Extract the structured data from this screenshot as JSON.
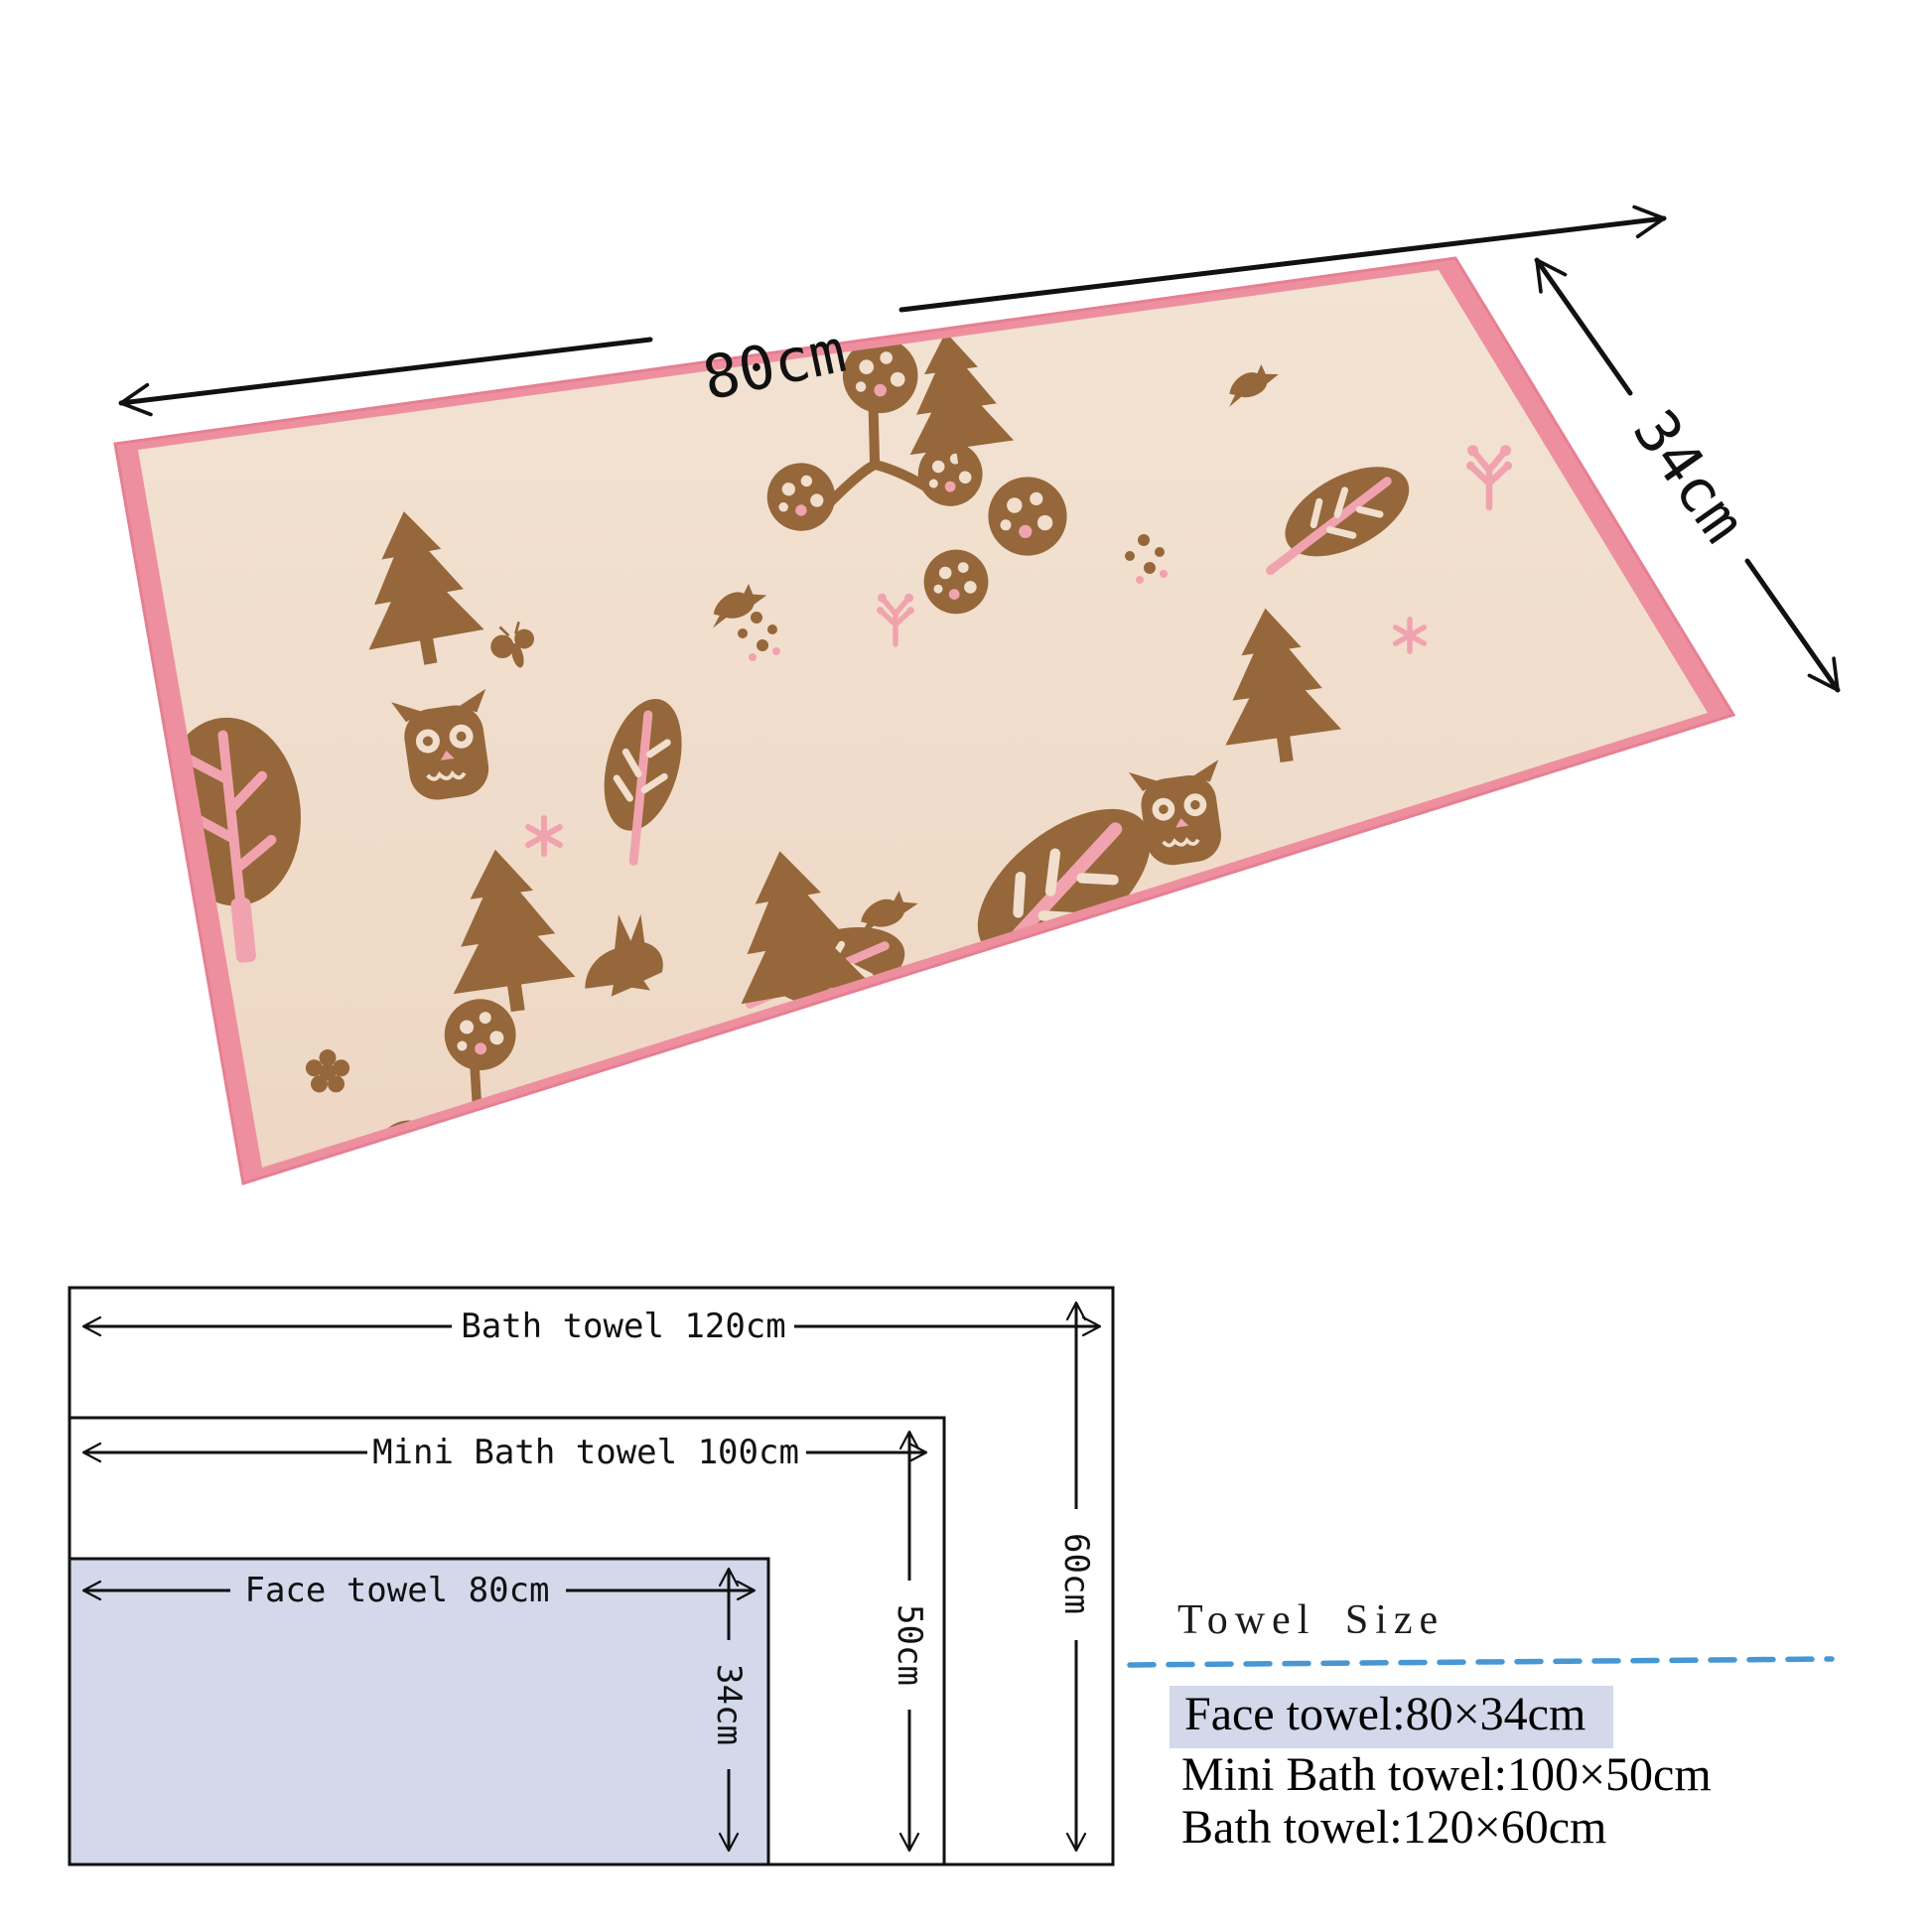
{
  "photo": {
    "width_label": "80cm",
    "height_label": "34cm",
    "motifs": [
      "round-tree",
      "pine-tree",
      "leaf",
      "owl",
      "bird",
      "rabbit",
      "berry-cluster",
      "flower",
      "butterfly",
      "sprig",
      "snowflake",
      "specks"
    ]
  },
  "diagram": {
    "bath_label": "Bath towel 120cm",
    "bath_height_label": "60cm",
    "mini_label": "Mini Bath towel 100cm",
    "mini_height_label": "50cm",
    "face_label": "Face towel 80cm",
    "face_height_label": "34cm"
  },
  "panel": {
    "title": "Towel Size",
    "items": [
      {
        "label": "Face towel:80×34cm",
        "highlighted": true
      },
      {
        "label": "Mini Bath towel:100×50cm",
        "highlighted": false
      },
      {
        "label": "Bath towel:120×60cm",
        "highlighted": false
      }
    ]
  },
  "colors": {
    "towel_border_pink": "#ee8f9f",
    "towel_base_beige": "#f1decd",
    "motif_brown": "#95673a",
    "accent_pink": "#f0a3ae",
    "highlight_lavender": "#d3d8ea",
    "divider_blue": "#4697d4",
    "line_black": "#111111"
  }
}
